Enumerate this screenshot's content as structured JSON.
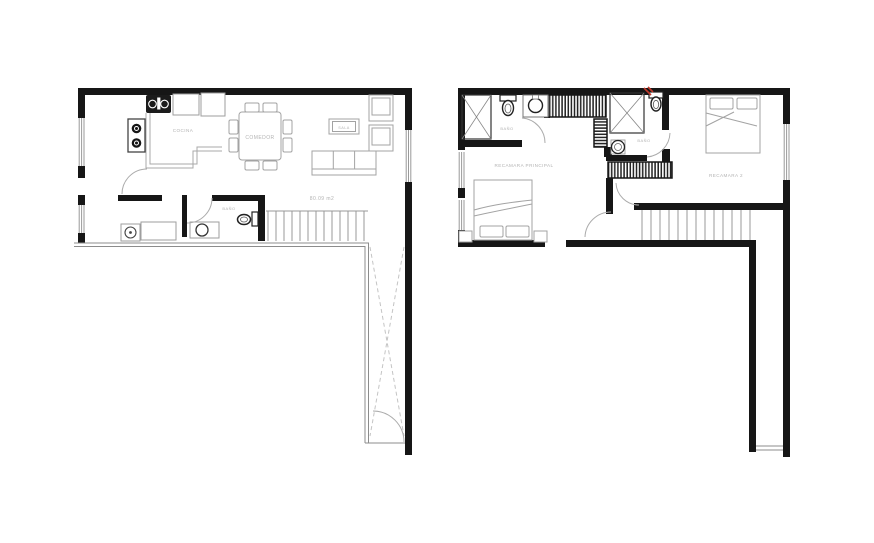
{
  "floorplan": {
    "ground_floor": {
      "labels": {
        "cocina": "COCINA",
        "comedor": "COMEDOR",
        "sala": "SALA",
        "bano": "BAÑO",
        "area": "80.09 m2"
      }
    },
    "upper_floor": {
      "labels": {
        "bano_1": "BAÑO",
        "bano_2": "BAÑO",
        "recamara_principal": "RECAMARA PRINCIPAL",
        "recamara_2": "RECAMARA 2"
      }
    },
    "colors": {
      "wall": "#161616",
      "furniture_line": "#a3a3a3",
      "fixture_line": "#333333",
      "label_text": "#b3b3b3",
      "accent_red": "#c0392b",
      "background": "#ffffff"
    }
  }
}
